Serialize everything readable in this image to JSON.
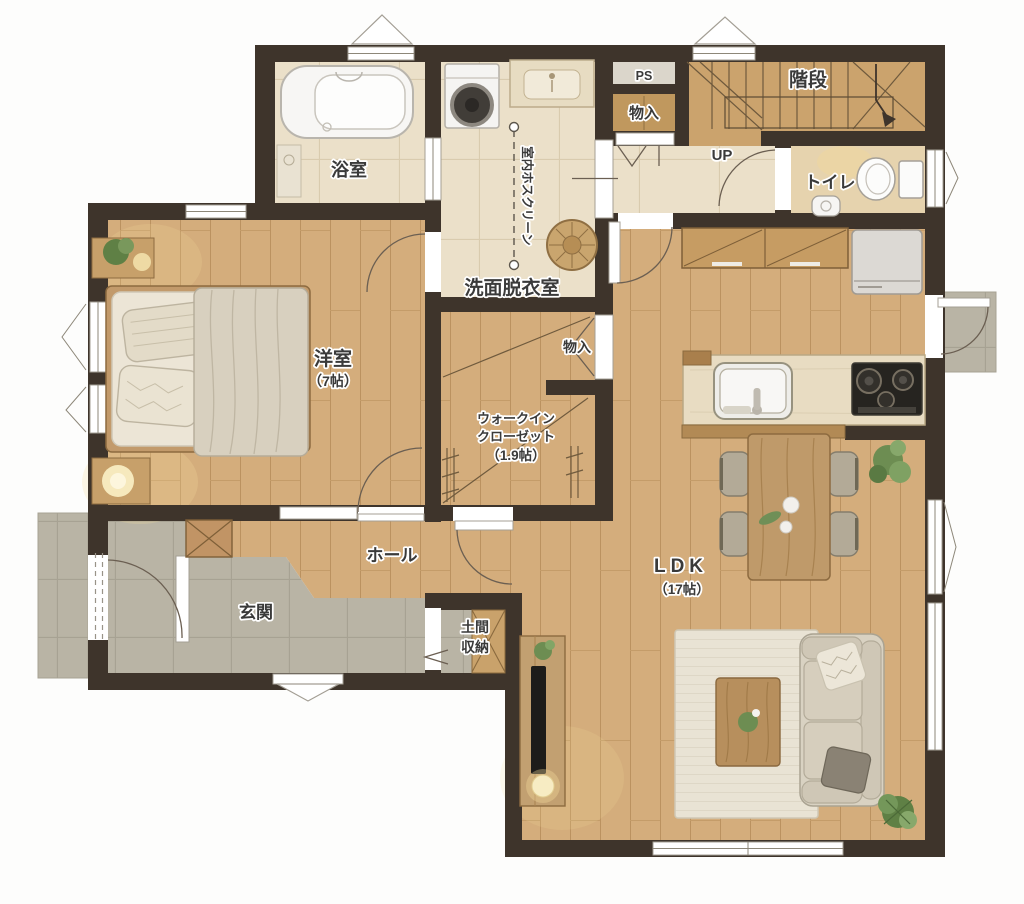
{
  "title": "1F floor plan",
  "labels": {
    "ps": "PS",
    "storage_top": "物入",
    "stairs": "階段",
    "up": "UP",
    "toilet": "トイレ",
    "bathroom": "浴室",
    "hoscreen": "室内ホスクリーン",
    "washroom": "洗面脱衣室",
    "storage_mid": "物入",
    "bedroom": "洋室",
    "bedroom_size": "（7帖）",
    "wic_line1": "ウォークイン",
    "wic_line2": "クローゼット",
    "wic_size": "（1.9帖）",
    "hall": "ホール",
    "entrance": "玄関",
    "doma_line1": "土間",
    "doma_line2": "収納",
    "ldk": "LDK",
    "ldk_size": "（17帖）"
  },
  "colors": {
    "wall": "#3e342b",
    "wood_floor": "#d4ad7c",
    "wood_dark": "#bb9260",
    "tile_beige": "#ebe0c9",
    "tile_gray": "#b9b4a5",
    "counter": "#e8dcc2",
    "stove": "#262420",
    "plant_green": "#6d8d52",
    "lamp_glow": "#f5dd9d",
    "label_text": "#3a3a3a"
  }
}
